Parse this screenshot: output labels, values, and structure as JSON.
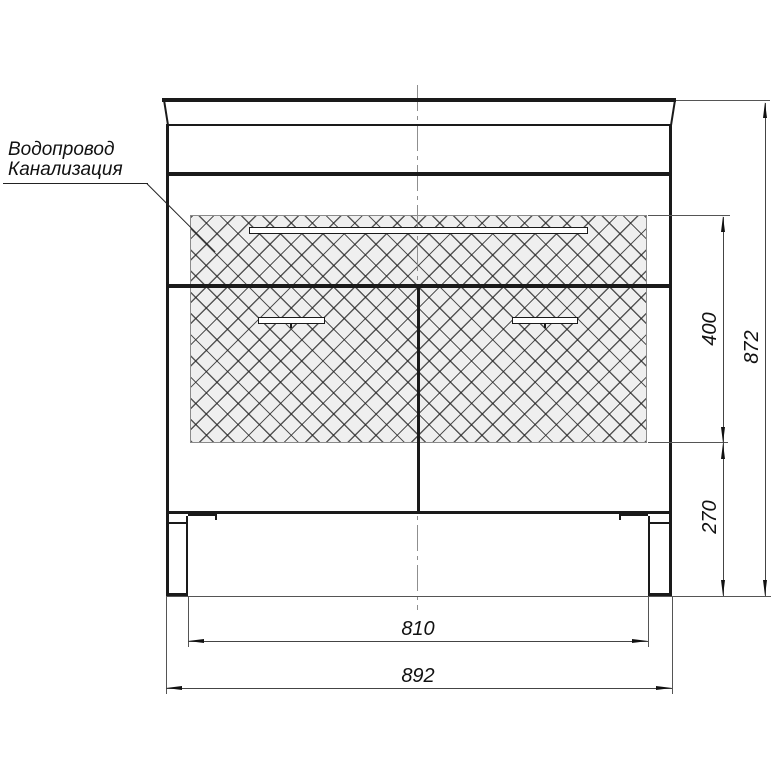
{
  "callout": {
    "line1": "Водопровод",
    "line2": "Канализация"
  },
  "dimensions": {
    "overall_height": "872",
    "hatch_zone_height": "400",
    "leg_zone_height": "270",
    "inner_width": "810",
    "overall_width": "892"
  },
  "colors": {
    "outline": "#1a1a1a",
    "dimension_line": "#555555",
    "hatch_fill": "#efefef",
    "centerline": "#8f8f8f",
    "background": "#ffffff"
  }
}
